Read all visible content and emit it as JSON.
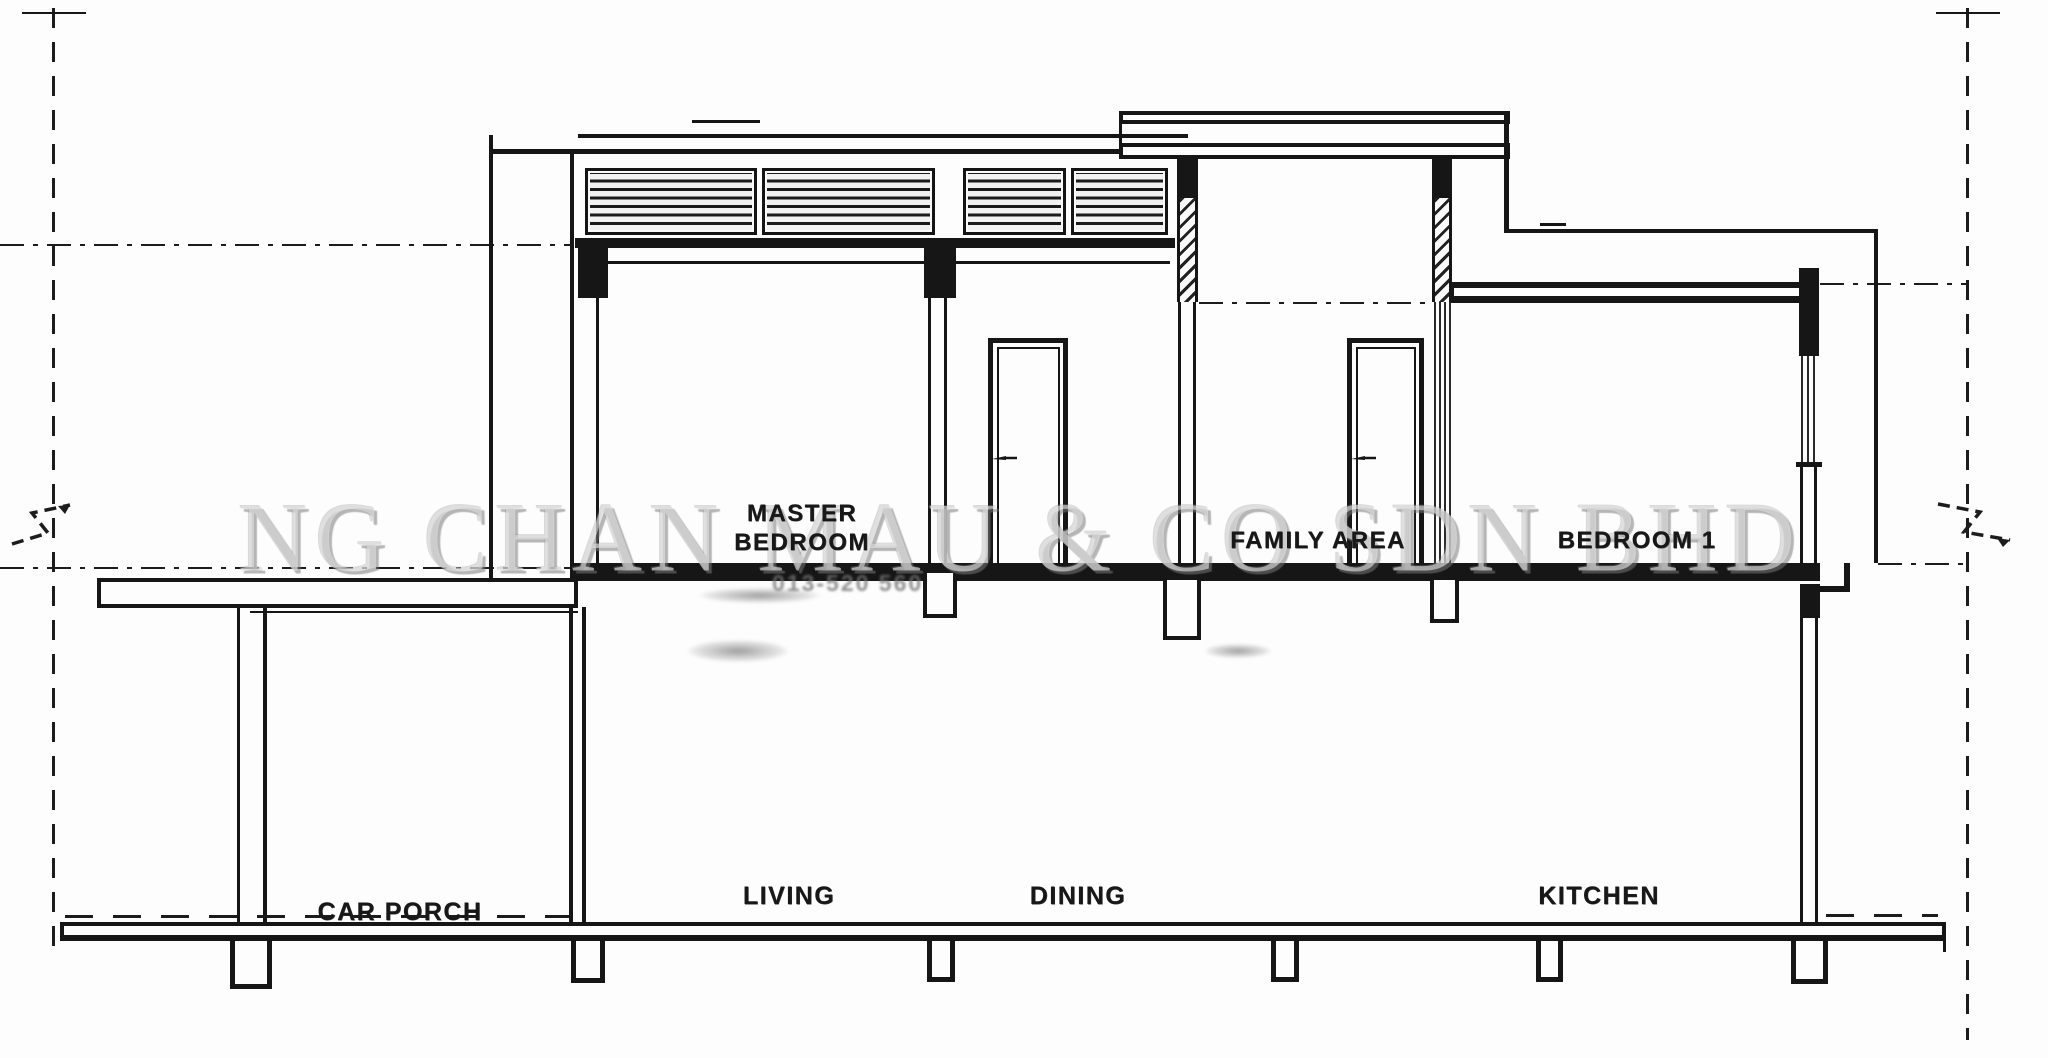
{
  "watermark": {
    "text": "NG CHAN MAU & CO SDN BHD",
    "phone_text": "013-520 560",
    "color": "#9a9a9a"
  },
  "rooms": {
    "upper_floor": [
      {
        "id": "master-bedroom",
        "label_line1": "MASTER",
        "label_line2": "BEDROOM"
      },
      {
        "id": "family-area",
        "label": "FAMILY AREA"
      },
      {
        "id": "bedroom-1",
        "label": "BEDROOM 1"
      }
    ],
    "ground_floor": [
      {
        "id": "car-porch",
        "label": "CAR PORCH"
      },
      {
        "id": "living",
        "label": "LIVING"
      },
      {
        "id": "dining",
        "label": "DINING"
      },
      {
        "id": "kitchen",
        "label": "KITCHEN"
      }
    ]
  },
  "colors": {
    "line": "#161616",
    "background": "#fdfdfd",
    "watermark_gray": "#9a9a9a"
  }
}
